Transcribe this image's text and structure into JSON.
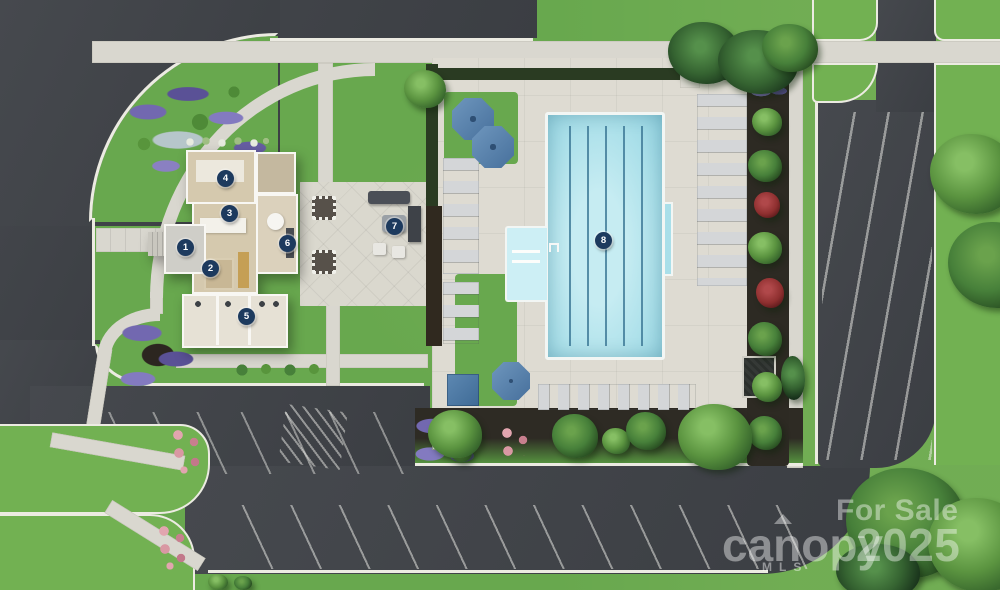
{
  "markers": [
    {
      "label": "1"
    },
    {
      "label": "2"
    },
    {
      "label": "3"
    },
    {
      "label": "4"
    },
    {
      "label": "5"
    },
    {
      "label": "6"
    },
    {
      "label": "7"
    },
    {
      "label": "8"
    }
  ],
  "watermark": {
    "for_sale": "For Sale",
    "brand": "canopy",
    "sub": "MLS",
    "year": "2025"
  },
  "colors": {
    "grass": "#68a84e",
    "asphalt": "#43464b",
    "curb": "#ecebe2",
    "concrete": "#d9d7cf",
    "pool_water": "#a9dfe9",
    "pool_lane": "#3a7694",
    "marker_navy": "#1d3a5e",
    "umbrella_blue": "#5b86b3",
    "flower_purple": "#7268b0",
    "flower_pink": "#d998a3"
  }
}
